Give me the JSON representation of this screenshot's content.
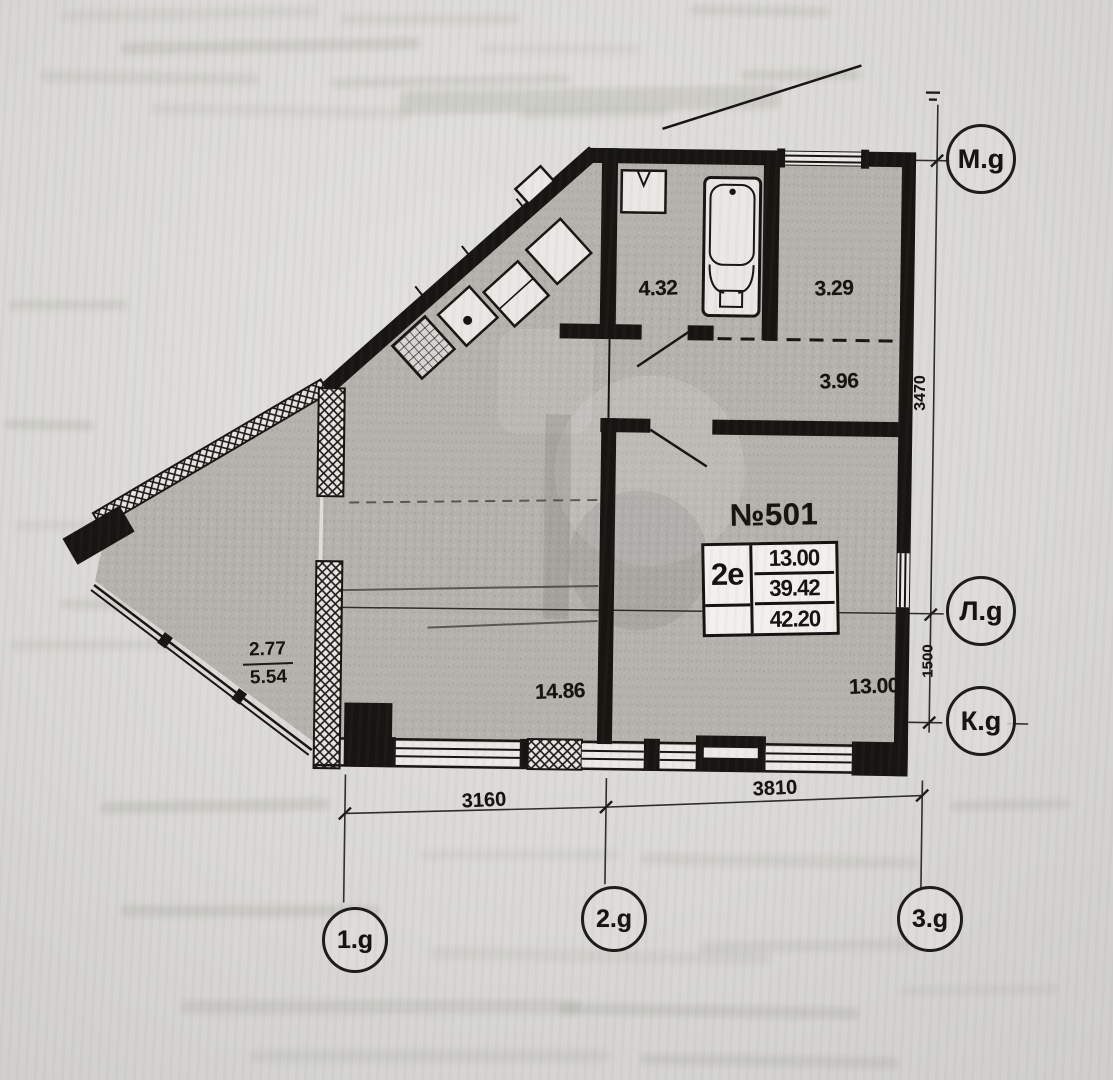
{
  "stamp": {
    "apartment_no": "№501",
    "type": "2е",
    "areas": [
      "13.00",
      "39.42",
      "42.20"
    ]
  },
  "rooms": {
    "bathroom": "4.32",
    "storage": "3.29",
    "hall": "3.96",
    "living": "14.86",
    "bedroom": "13.00",
    "balcony": {
      "reduced": "2.77",
      "full": "5.54"
    }
  },
  "dimensions": {
    "bottom_left": "3160",
    "bottom_right": "3810",
    "right_upper": "3470",
    "right_lower": "1500"
  },
  "axes": {
    "m": "М.g",
    "l": "Л.g",
    "k": "К.g",
    "a1": "1.g",
    "a2": "2.g",
    "a3": "3.g"
  }
}
